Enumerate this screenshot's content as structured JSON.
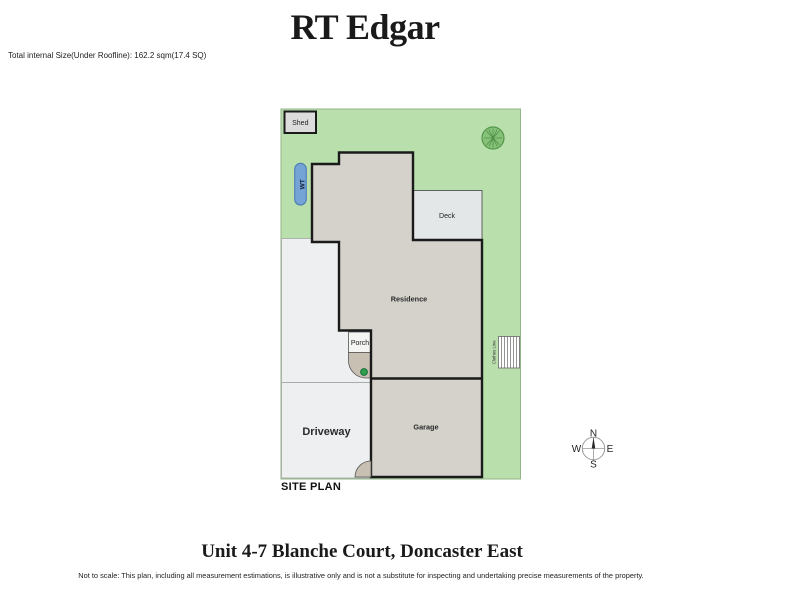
{
  "header": {
    "brand": "RT Edgar",
    "size_note": "Total internal Size(Under Roofline): 162.2 sqm(17.4 SQ)"
  },
  "site_plan": {
    "label": "SITE PLAN",
    "areas": {
      "shed": "Shed",
      "water_tank": "WT",
      "deck": "Deck",
      "residence": "Residence",
      "porch": "Porch",
      "garage": "Garage",
      "driveway": "Driveway",
      "clothes_line": "Clothes Line"
    }
  },
  "compass": {
    "north": "N",
    "south": "S",
    "east": "E",
    "west": "W"
  },
  "footer": {
    "address": "Unit 4-7 Blanche Court, Doncaster East",
    "disclaimer": "Not to scale: This plan, including all measurement estimations, is illustrative only and is not a substitute for inspecting and  undertaking precise measurements of the property."
  },
  "colors": {
    "lawn": "#b9dfac",
    "lawn_border": "#93b588",
    "tree_fill": "#87c279",
    "tree_line": "#4d8c44",
    "building_fill": "#d5d2cc",
    "wall": "#1a1a1a",
    "deck_fill": "#e4e7e7",
    "paving_fill": "#edeff1",
    "paving_border": "#a9ada9",
    "porch_tan": "#c8c0b3",
    "water_tank_fill": "#74a3d6",
    "water_tank_border": "#4d7db5",
    "garden_dot": "#2f9e4d"
  }
}
